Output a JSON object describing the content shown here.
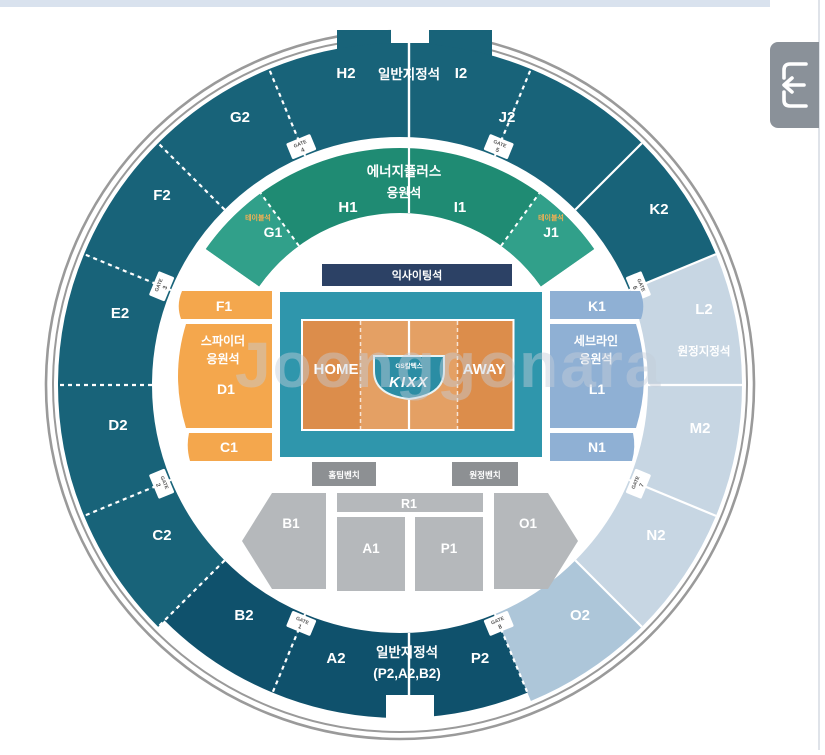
{
  "watermark": "Joonggonara",
  "toolbar": {
    "collapse_button_icon": "arrow-left-into-bracket"
  },
  "arena": {
    "colors": {
      "dark": "#186379",
      "darkest": "#0f516c",
      "light": "#c7d6e3",
      "light2": "#adc6d9",
      "green": "#1f8b73",
      "green_light": "#31a08a",
      "orange": "#f4a74d",
      "blue": "#8fb0d4",
      "court": "#2f96ac",
      "court_orange": "#dc8d4b",
      "court_orange_light": "#e4a064",
      "navy": "#2c4165",
      "gray": "#b5b8bb",
      "bench": "#8d9093",
      "ring": "#9a9a9a",
      "gate_text": "#555555"
    },
    "top_label": "일반지정석",
    "bottom_label_1": "일반지정석",
    "bottom_label_2": "(P2,A2,B2)",
    "l2_sublabel": "원정지정석",
    "gate_word": "GATE",
    "sections": [
      {
        "id": "I2",
        "b1": 0,
        "b2": 22.5,
        "color": "dark",
        "lx": 461,
        "ly": 78
      },
      {
        "id": "J2",
        "b1": 22.5,
        "b2": 45,
        "color": "dark",
        "lx": 507,
        "ly": 122
      },
      {
        "id": "K2",
        "b1": 45,
        "b2": 67.5,
        "color": "dark",
        "lx": 659,
        "ly": 214
      },
      {
        "id": "L2",
        "b1": 67.5,
        "b2": 90,
        "color": "light",
        "lx": 704,
        "ly": 314
      },
      {
        "id": "M2",
        "b1": 90,
        "b2": 112.5,
        "color": "light",
        "lx": 700,
        "ly": 433
      },
      {
        "id": "N2",
        "b1": 112.5,
        "b2": 135,
        "color": "light",
        "lx": 656,
        "ly": 540
      },
      {
        "id": "O2",
        "b1": 135,
        "b2": 157.5,
        "color": "light2",
        "lx": 580,
        "ly": 620
      },
      {
        "id": "P2",
        "b1": 157.5,
        "b2": 180,
        "color": "darkest",
        "lx": 480,
        "ly": 663,
        "outer": 333
      },
      {
        "id": "A2",
        "b1": 180,
        "b2": 202.5,
        "color": "darkest",
        "lx": 336,
        "ly": 663,
        "outer": 333
      },
      {
        "id": "B2",
        "b1": 202.5,
        "b2": 225,
        "color": "darkest",
        "lx": 244,
        "ly": 620,
        "outer": 333
      },
      {
        "id": "C2",
        "b1": 225,
        "b2": 247.5,
        "color": "dark",
        "lx": 162,
        "ly": 540
      },
      {
        "id": "D2",
        "b1": 247.5,
        "b2": 270,
        "color": "dark",
        "lx": 118,
        "ly": 430
      },
      {
        "id": "E2",
        "b1": 270,
        "b2": 292.5,
        "color": "dark",
        "lx": 120,
        "ly": 318
      },
      {
        "id": "F2",
        "b1": 292.5,
        "b2": 315,
        "color": "dark",
        "lx": 162,
        "ly": 200
      },
      {
        "id": "G2",
        "b1": 315,
        "b2": 337.5,
        "color": "dark",
        "lx": 240,
        "ly": 122
      },
      {
        "id": "H2",
        "b1": 337.5,
        "b2": 360,
        "color": "dark",
        "lx": 346,
        "ly": 78
      }
    ],
    "boundaries": [
      {
        "b": 22.5,
        "d": 1
      },
      {
        "b": 45,
        "d": 0
      },
      {
        "b": 67.5,
        "d": 0
      },
      {
        "b": 90,
        "d": 0
      },
      {
        "b": 112.5,
        "d": 0
      },
      {
        "b": 135,
        "d": 0
      },
      {
        "b": 157.5,
        "d": 1
      },
      {
        "b": 202.5,
        "d": 1
      },
      {
        "b": 225,
        "d": 1
      },
      {
        "b": 247.5,
        "d": 1
      },
      {
        "b": 270,
        "d": 1
      },
      {
        "b": 292.5,
        "d": 1
      },
      {
        "b": 315,
        "d": 1
      },
      {
        "b": 337.5,
        "d": 1
      }
    ],
    "gates": [
      {
        "num": "1",
        "b": 202.5
      },
      {
        "num": "2",
        "b": 247.5
      },
      {
        "num": "3",
        "b": 292.5
      },
      {
        "num": "4",
        "b": 337.5
      },
      {
        "num": "5",
        "b": 22.5
      },
      {
        "num": "6",
        "b": 67.5
      },
      {
        "num": "7",
        "b": 112.5
      },
      {
        "num": "8",
        "b": 157.5
      }
    ],
    "green_band": {
      "line1": "에너지플러스",
      "line2": "응원석",
      "h1": "H1",
      "i1": "I1",
      "g1": "G1",
      "j1": "J1",
      "mini": "테이블석"
    },
    "left_block": {
      "f1": "F1",
      "line1": "스파이더",
      "line2": "응원석",
      "d1": "D1",
      "c1": "C1"
    },
    "right_block": {
      "k1": "K1",
      "line1": "세브라인",
      "line2": "응원석",
      "l1": "L1",
      "n1": "N1"
    },
    "court": {
      "banner": "익사이팅석",
      "home": "HOME",
      "away": "AWAY",
      "logo_small": "GS칼텍스",
      "logo": "KIXX",
      "bench_left": "홈팀벤치",
      "bench_right": "원정벤치"
    },
    "floor": {
      "r1": "R1",
      "a1": "A1",
      "p1": "P1",
      "b1": "B1",
      "o1": "O1"
    }
  }
}
